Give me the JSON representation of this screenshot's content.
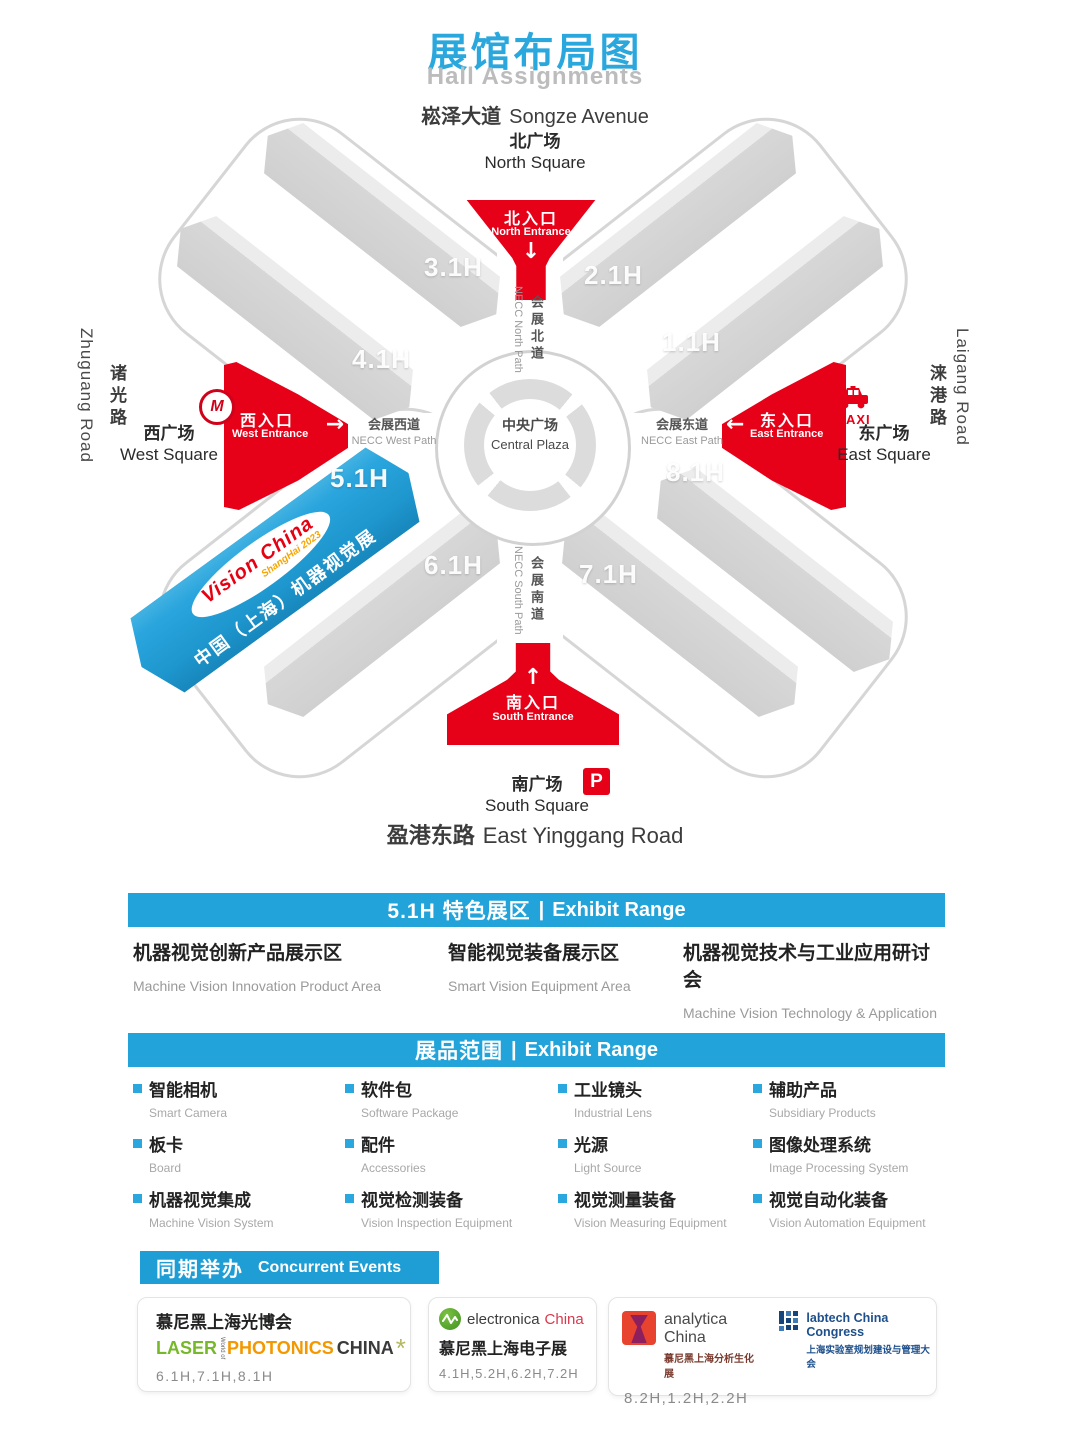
{
  "colors": {
    "accent_cyan": "#22a3d9",
    "title_cyan": "#2aa7dc",
    "entrance_red": "#e60018",
    "feature_hall_blue": "#1e96ce",
    "hall_gray": "#d7d7d7"
  },
  "header": {
    "title_zh": "展馆布局图",
    "title_en": "Hall Assignments"
  },
  "map": {
    "roads": {
      "north": {
        "zh": "崧泽大道",
        "en": "Songze Avenue"
      },
      "south": {
        "zh": "盈港东路",
        "en": "East Yinggang Road"
      },
      "west": {
        "zh": "诸光路",
        "en": "Zhuguang Road"
      },
      "east": {
        "zh": "涞港路",
        "en": "Laigang Road"
      }
    },
    "squares": {
      "north": {
        "zh": "北广场",
        "en": "North Square"
      },
      "south": {
        "zh": "南广场",
        "en": "South Square"
      },
      "west": {
        "zh": "西广场",
        "en": "West Square"
      },
      "east": {
        "zh": "东广场",
        "en": "East Square"
      }
    },
    "entrances": {
      "north": {
        "zh": "北入口",
        "en": "North Entrance",
        "arrow": "↓"
      },
      "south": {
        "zh": "南入口",
        "en": "South Entrance",
        "arrow": "↑"
      },
      "west": {
        "zh": "西入口",
        "en": "West Entrance",
        "arrow": "→"
      },
      "east": {
        "zh": "东入口",
        "en": "East Entrance",
        "arrow": "←"
      }
    },
    "paths": {
      "north": {
        "zh": "会展北道",
        "en": "NECC North Path"
      },
      "south": {
        "zh": "会展南道",
        "en": "NECC South Path"
      },
      "west": {
        "zh": "会展西道",
        "en": "NECC West Path"
      },
      "east": {
        "zh": "会展东道",
        "en": "NECC East Path"
      }
    },
    "plaza": {
      "zh": "中央广场",
      "en": "Central Plaza"
    },
    "halls": {
      "h11": "1.1H",
      "h21": "2.1H",
      "h31": "3.1H",
      "h41": "4.1H",
      "h51": "5.1H",
      "h61": "6.1H",
      "h71": "7.1H",
      "h81": "8.1H"
    },
    "feature_hall": {
      "logo_line1": "Vision China",
      "logo_line2": "ShangHai 2023",
      "banner": "中国（上海）机器视觉展"
    },
    "badges": {
      "metro": "M",
      "taxi": "TAXI",
      "parking": "P"
    }
  },
  "sections": {
    "feature": {
      "title_zh": "5.1H 特色展区",
      "divider": "|",
      "title_en": "Exhibit Range",
      "items": [
        {
          "zh": "机器视觉创新产品展示区",
          "en": "Machine Vision Innovation Product Area"
        },
        {
          "zh": "智能视觉装备展示区",
          "en": "Smart Vision Equipment Area"
        },
        {
          "zh": "机器视觉技术与工业应用研讨会",
          "en": "Machine Vision Technology & Application Conference"
        }
      ]
    },
    "products": {
      "title_zh": "展品范围",
      "divider": "|",
      "title_en": "Exhibit Range",
      "items": [
        {
          "zh": "智能相机",
          "en": "Smart Camera"
        },
        {
          "zh": "软件包",
          "en": "Software Package"
        },
        {
          "zh": "工业镜头",
          "en": "Industrial Lens"
        },
        {
          "zh": "辅助产品",
          "en": "Subsidiary Products"
        },
        {
          "zh": "板卡",
          "en": "Board"
        },
        {
          "zh": "配件",
          "en": "Accessories"
        },
        {
          "zh": "光源",
          "en": "Light Source"
        },
        {
          "zh": "图像处理系统",
          "en": "Image Processing System"
        },
        {
          "zh": "机器视觉集成",
          "en": "Machine Vision System"
        },
        {
          "zh": "视觉检测装备",
          "en": "Vision Inspection Equipment"
        },
        {
          "zh": "视觉测量装备",
          "en": "Vision Measuring Equipment"
        },
        {
          "zh": "视觉自动化装备",
          "en": "Vision Automation Equipment"
        }
      ]
    },
    "events": {
      "title_zh": "同期举办",
      "title_en": "Concurrent Events",
      "cards": [
        {
          "title_zh": "慕尼黑上海光博会",
          "logo_laser": "LASER",
          "logo_worldof": "World of",
          "logo_photonics": "PHOTONICS",
          "logo_china": "CHINA",
          "logo_sparkle": "*",
          "halls": "6.1H,7.1H,8.1H"
        },
        {
          "logo_name": "electronica",
          "logo_region": "China",
          "title_zh": "慕尼黑上海电子展",
          "halls": "4.1H,5.2H,6.2H,7.2H"
        },
        {
          "logo1_name": "analytica China",
          "logo1_zh": "慕尼黑上海分析生化展",
          "logo2_name": "labtech China Congress",
          "logo2_zh": "上海实验室规划建设与管理大会",
          "halls": "8.2H,1.2H,2.2H"
        }
      ]
    }
  }
}
